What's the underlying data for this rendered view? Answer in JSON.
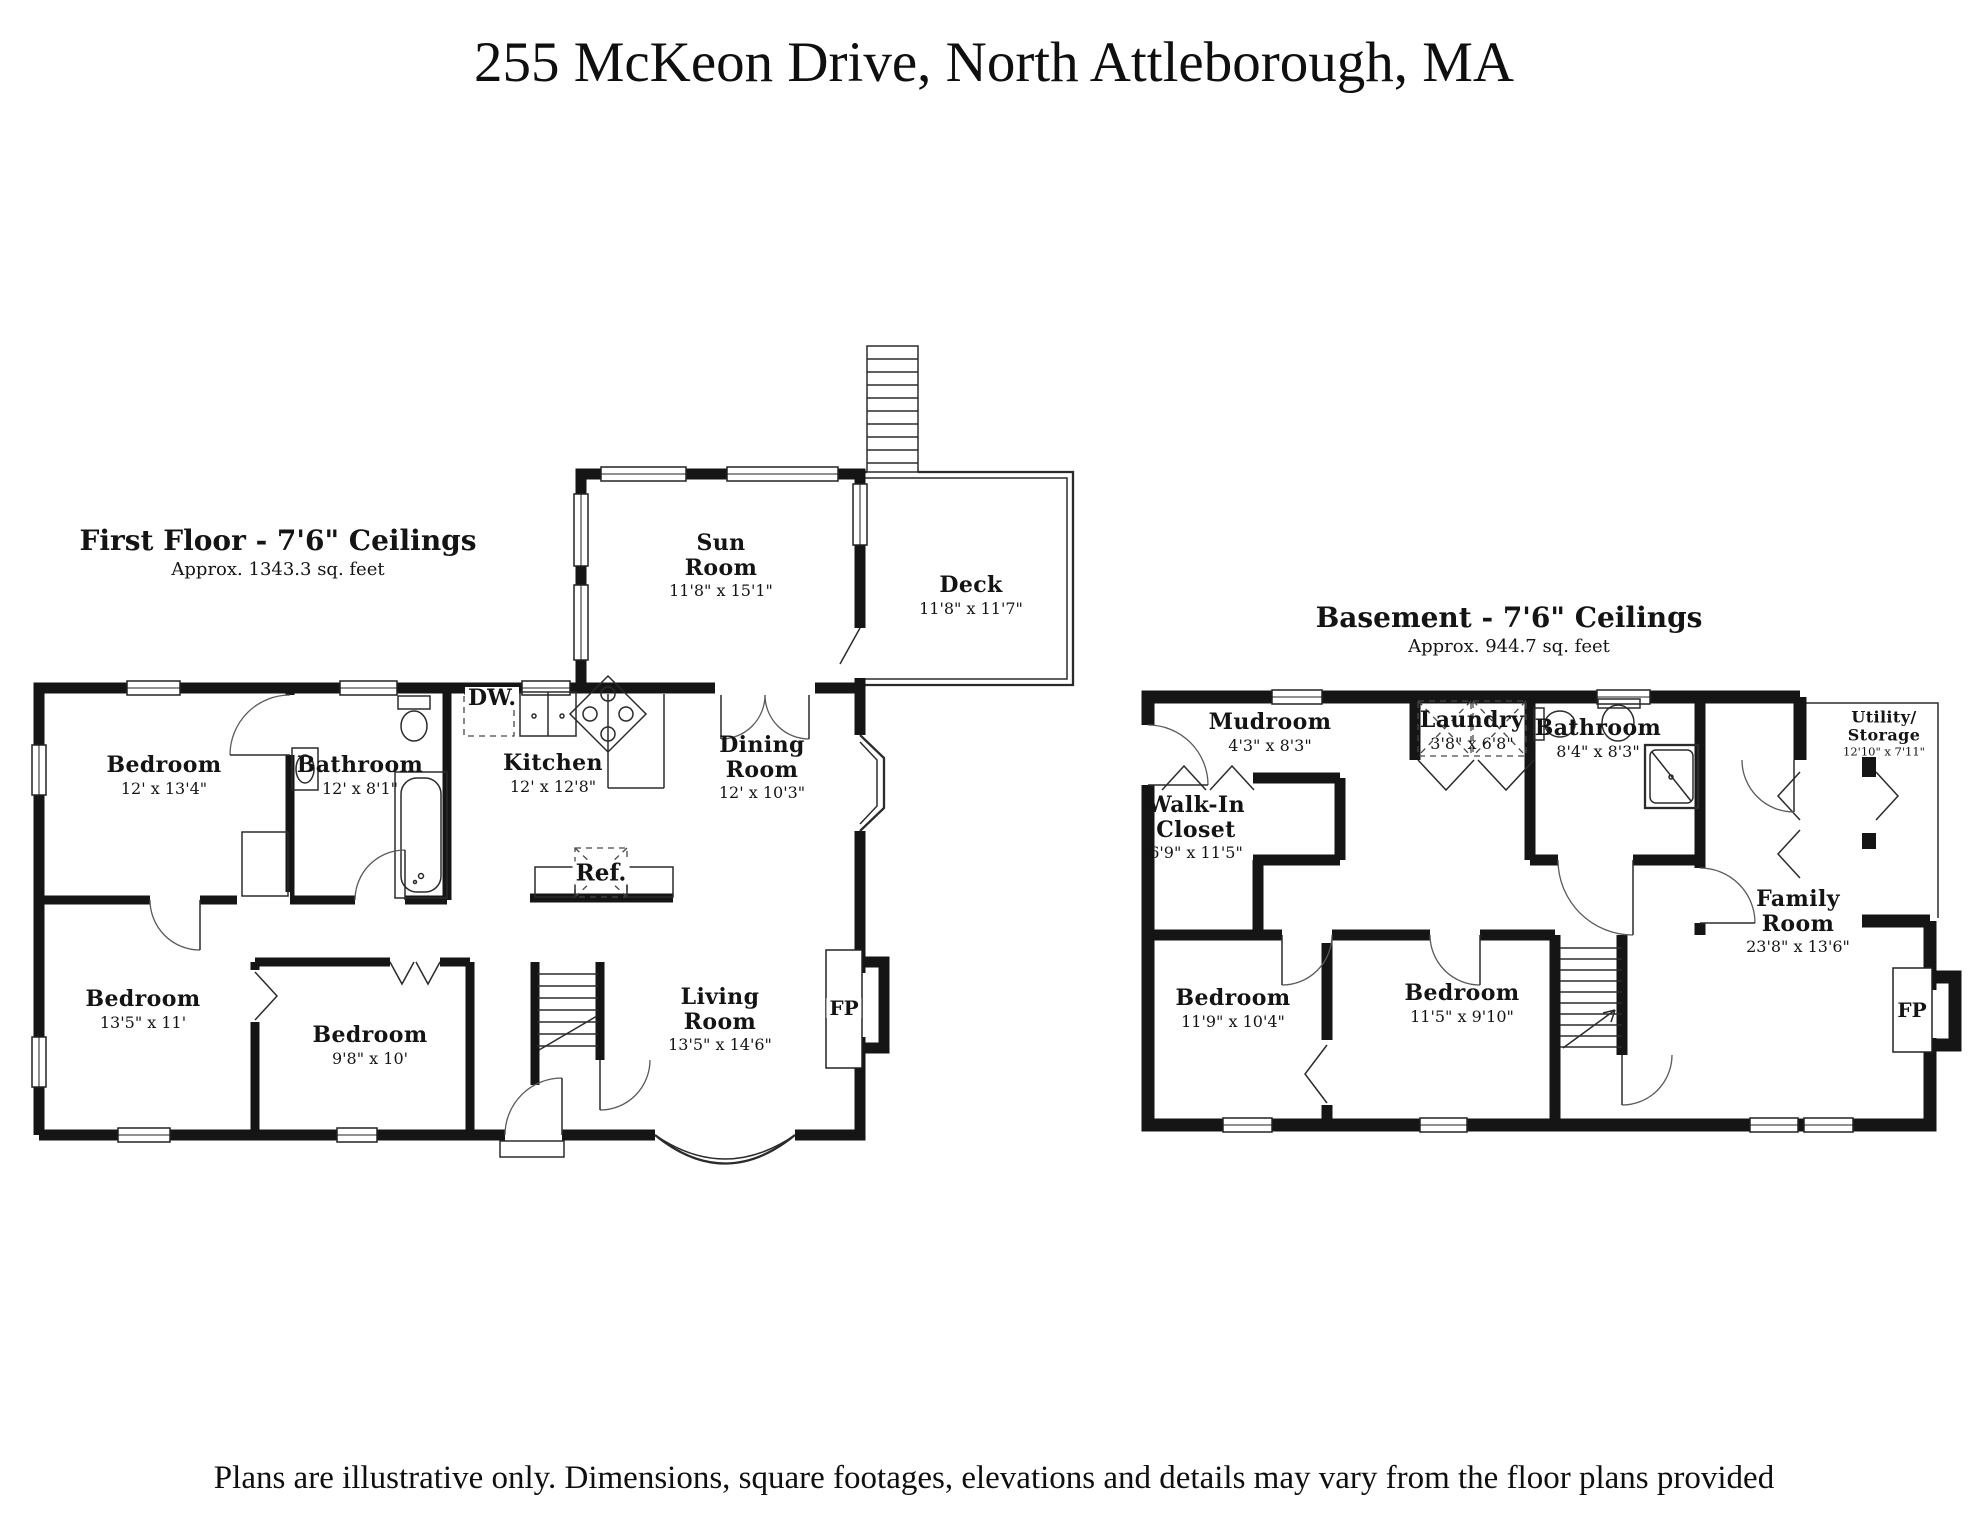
{
  "title": "255 McKeon Drive, North Attleborough, MA",
  "footer": "Plans are illustrative only. Dimensions, square footages, elevations and details may vary from the floor plans provided",
  "first_floor": {
    "heading": "First Floor - 7'6\" Ceilings",
    "area": "Approx. 1343.3 sq. feet",
    "rooms": [
      {
        "name": "Bedroom",
        "dims": "12' x 13'4\""
      },
      {
        "name": "Bathroom",
        "dims": "12' x 8'1\""
      },
      {
        "name": "Kitchen",
        "dims": "12' x 12'8\""
      },
      {
        "name": "Dining\nRoom",
        "dims": "12' x 10'3\""
      },
      {
        "name": "Sun\nRoom",
        "dims": "11'8\" x 15'1\""
      },
      {
        "name": "Deck",
        "dims": "11'8\" x 11'7\""
      },
      {
        "name": "Bedroom",
        "dims": "13'5\" x 11'"
      },
      {
        "name": "Bedroom",
        "dims": "9'8\" x 10'"
      },
      {
        "name": "Living\nRoom",
        "dims": "13'5\" x 14'6\""
      }
    ],
    "labels": {
      "dishwasher": "DW.",
      "refrigerator": "Ref.",
      "fireplace": "FP"
    }
  },
  "basement": {
    "heading": "Basement - 7'6\" Ceilings",
    "area": "Approx. 944.7 sq. feet",
    "rooms": [
      {
        "name": "Mudroom",
        "dims": "4'3\" x 8'3\""
      },
      {
        "name": "Laundry",
        "dims": "3'8\" x 6'8\""
      },
      {
        "name": "Bathroom",
        "dims": "8'4\" x 8'3\""
      },
      {
        "name": "Utility/\nStorage",
        "dims": "12'10\" x 7'11\""
      },
      {
        "name": "Walk-In\nCloset",
        "dims": "6'9\" x 11'5\""
      },
      {
        "name": "Bedroom",
        "dims": "11'9\" x 10'4\""
      },
      {
        "name": "Bedroom",
        "dims": "11'5\" x 9'10\""
      },
      {
        "name": "Family\nRoom",
        "dims": "23'8\" x 13'6\""
      }
    ],
    "labels": {
      "fireplace": "FP"
    }
  }
}
